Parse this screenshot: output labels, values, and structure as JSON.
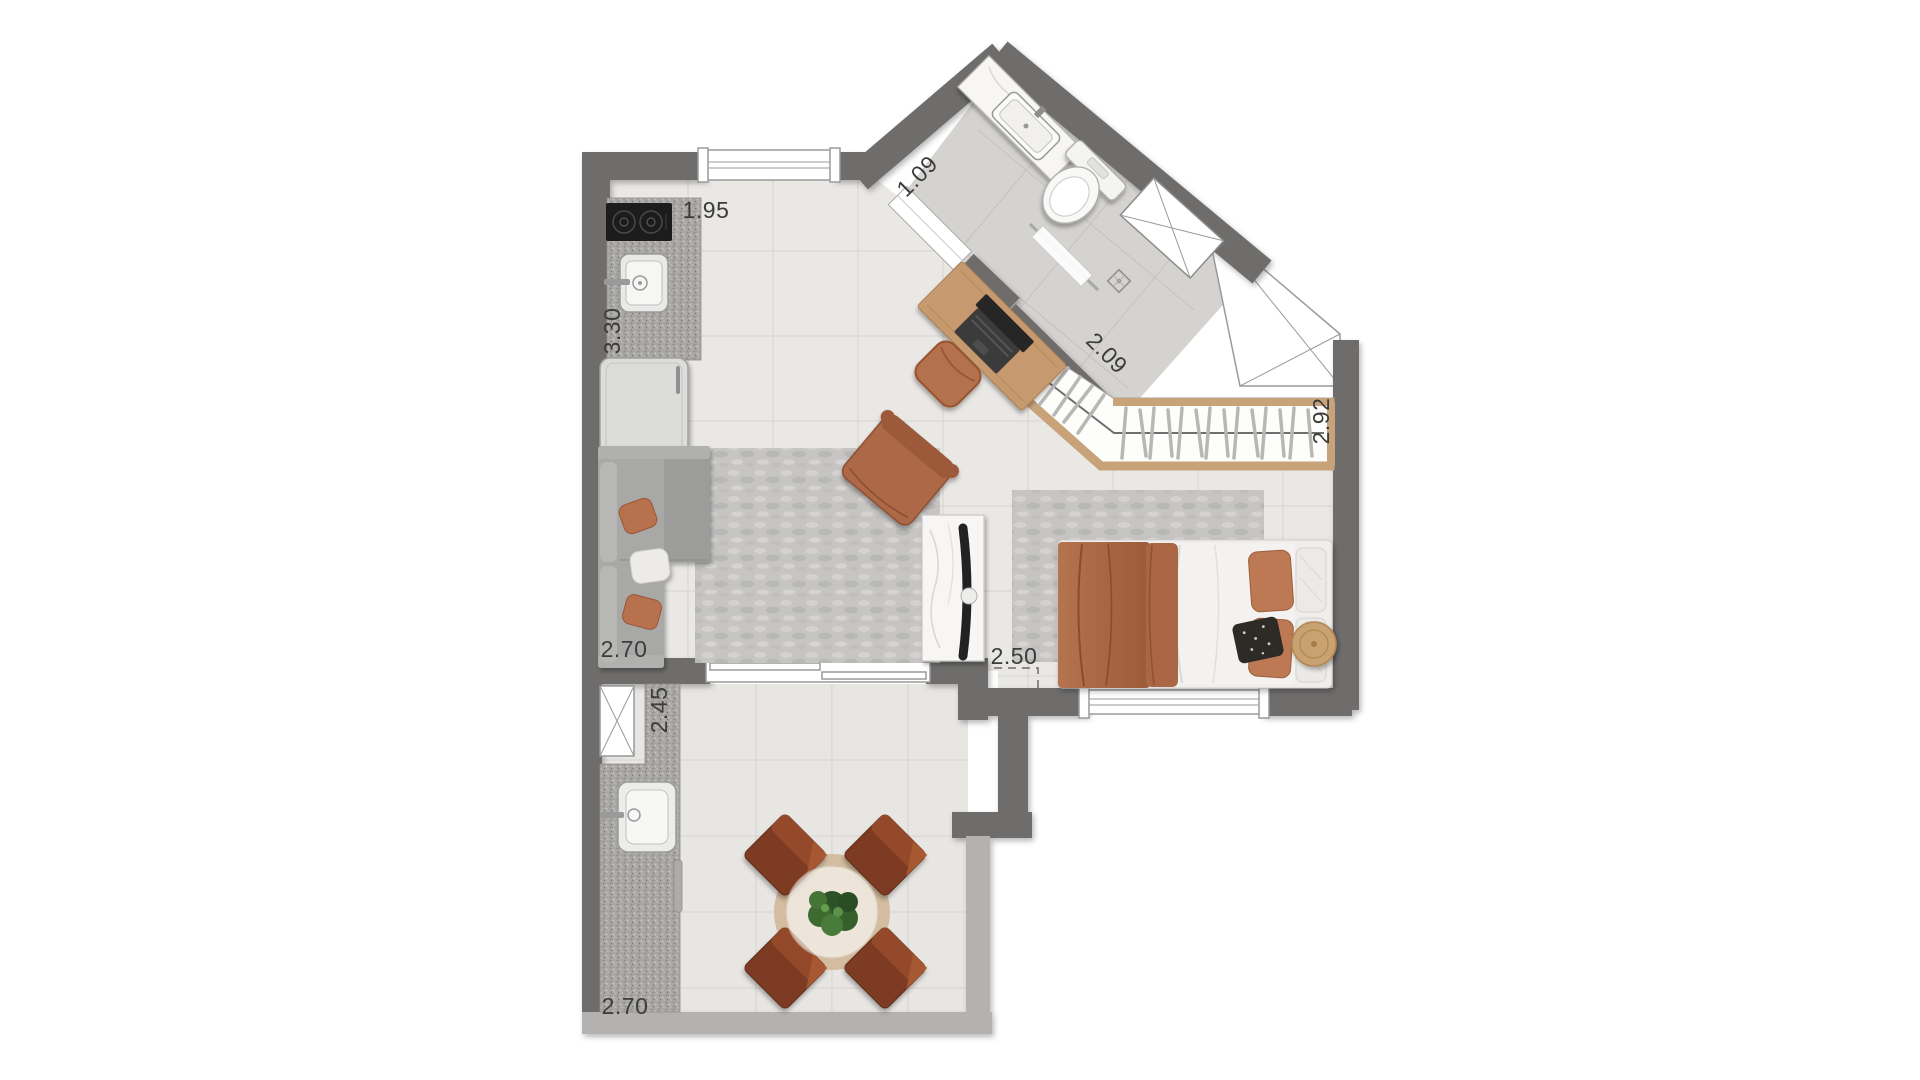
{
  "plan": {
    "dimensions": {
      "kitchen_top": "1.95",
      "kitchen_side": "3.30",
      "bath_entry": "1.09",
      "shower": "2.09",
      "closet": "2.92",
      "living": "2.70",
      "terrace_side": "2.45",
      "bedroom": "2.50",
      "terrace_bottom": "2.70"
    },
    "colors": {
      "wall": "#6e6d6c",
      "parapet": "#b3b2b0",
      "floor": "#eae8e5",
      "bath_floor": "#d5d3d0",
      "granite": "#a8a6a3",
      "wood_trim": "#c8a37a",
      "wood": "#c69a6e",
      "terracotta": "#b06a48",
      "label": "#3c3c3c"
    }
  }
}
